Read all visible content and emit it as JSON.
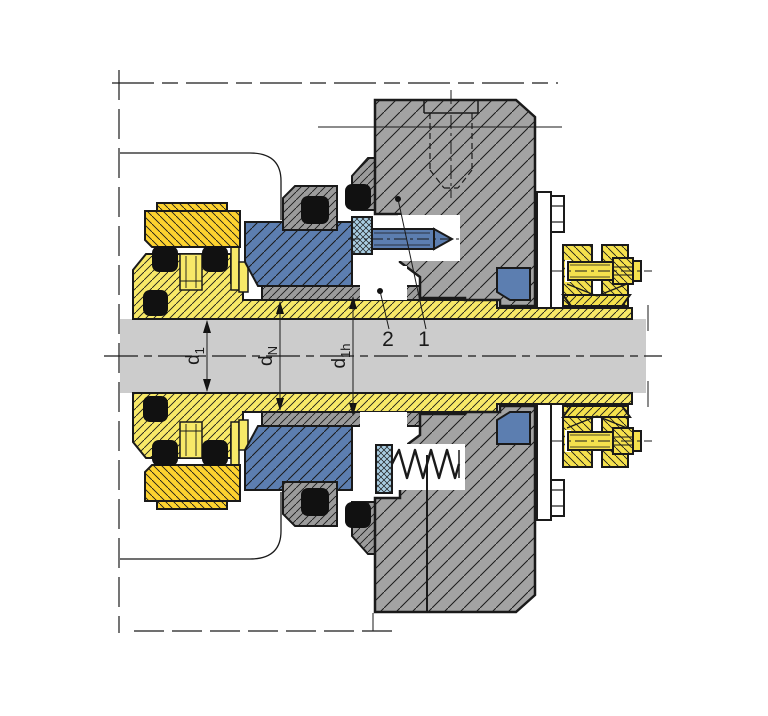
{
  "diagram": {
    "type": "technical-section-drawing",
    "description": "Mechanical seal cross-section installation drawing",
    "callouts": [
      {
        "label": "2"
      },
      {
        "label": "1"
      }
    ],
    "dimensions": [
      {
        "main": "d",
        "sub": "1"
      },
      {
        "main": "d",
        "sub": "N"
      },
      {
        "main": "d",
        "sub": "1h"
      }
    ],
    "colors": {
      "background": "#ffffff",
      "line": "#1a1a1a",
      "shaftGray": "#cccccc",
      "lightYellow": "#f8e968",
      "gold": "#fdd22f",
      "collarYellow": "#f5e14d",
      "blue": "#5c7eb0",
      "lightBlue": "#a9cde2",
      "medGray": "#9b9b9b",
      "housingGray": "#a3a3a3",
      "white": "#ffffff",
      "black": "#111111"
    }
  }
}
